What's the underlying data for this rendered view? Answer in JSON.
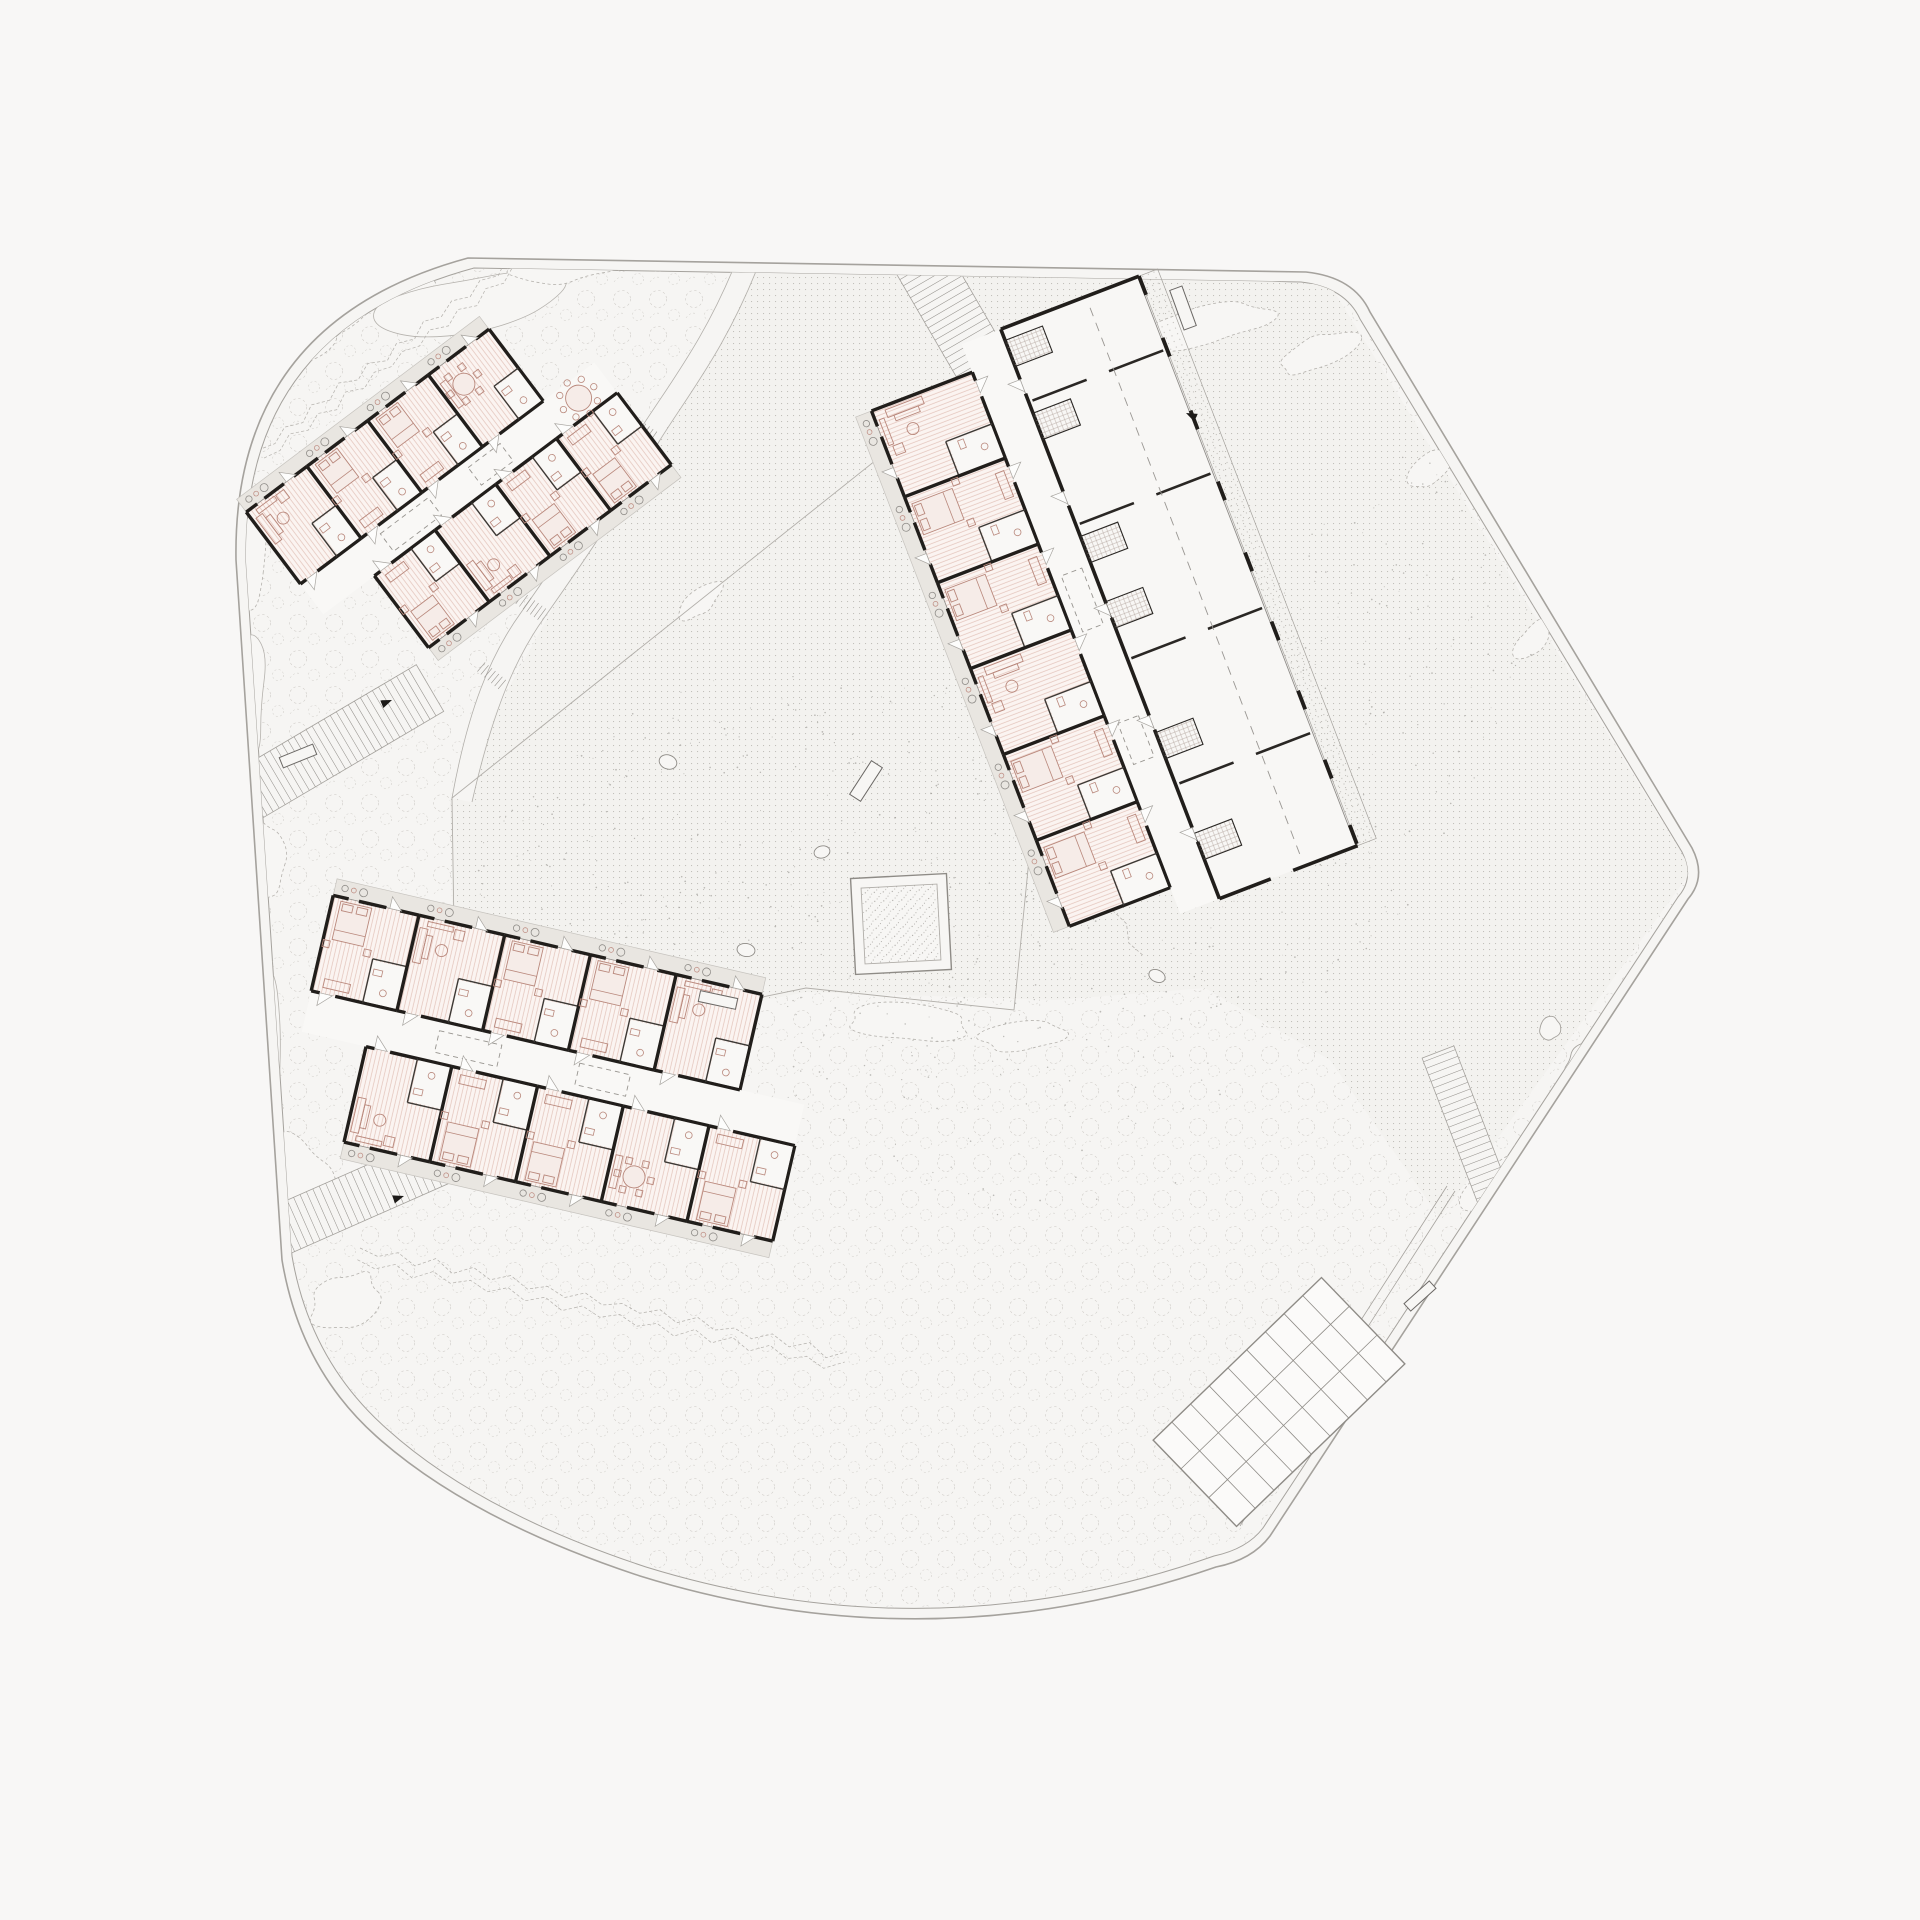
{
  "document": {
    "type": "architectural-site-plan",
    "level": "ground-floor",
    "text_labels": "none-visible"
  },
  "canvas": {
    "width": 1920,
    "height": 1920,
    "viewbox": "0 0 1920 1920",
    "background": "#f8f7f6"
  },
  "palette": {
    "paper": "#f8f7f6",
    "site_fill": "#f6f5f3",
    "blob_fill": "#f7f6f4",
    "boundary_line": "#a5a29d",
    "texture_line": "#cbc8c3",
    "dot": "#b7b4af",
    "wall": "#211e1b",
    "inner_wall": "#3c3935",
    "thin_line": "#8f8c88",
    "floor_base": "#fbf4f1",
    "floor_hatch": "#e3c5bc",
    "porch_fill": "#e9e6e1",
    "furniture": "#b9887c",
    "furniture_fill": "#f6ece8",
    "hatch_path_line": "#96938e",
    "ground_dots_fill": "#f3f2ef",
    "pavilion_line": "#8e8b86",
    "speck": "#8d8a85",
    "arrow": "#1c1a18"
  },
  "site": {
    "outer": "M 468 258 L 1306 272 Q 1354 277 1370 312 L 1692 848 Q 1707 877 1688 899 L 1270 1536 Q 1252 1560 1216 1567 Q 930 1666 640 1576 Q 470 1520 376 1436 Q 300 1368 282 1260 L 236 560 Q 232 322 468 258 Z",
    "inner": "M 474 268 L 1301 282 Q 1345 287 1360 319 L 1682 852 Q 1695 878 1678 897 L 1263 1528 Q 1247 1549 1214 1556 Q 932 1655 646 1567 Q 479 1512 387 1429 Q 310 1361 292 1256 L 246 562 Q 242 331 474 268 Z",
    "ground_dots_region": "M 750 250 L 1330 285 L 1692 870 L 1440 1218 L 1330 1060 L 1205 988 L 1056 1000 L 806 992 L 455 1062 L 450 795 Z",
    "courtyard_border": "M 452 798 L 905 437 L 1062 528 L 1014 1010 L 806 988 L 456 1060 Z"
  },
  "stream": {
    "mid": "M 750 254 C 716 343 677 390 647 438 C 609 502 579 548 531 616 C 501 658 479 712 461 800",
    "left": "M 740 252 C 706 340 666 388 636 436 C 598 500 568 546 520 614 C 490 656 468 710 452 798",
    "right": "M 762 256 C 728 346 690 392 660 440 C 622 504 592 550 544 618 C 514 660 492 714 472 802"
  },
  "hatch_steps": [
    {
      "x": 641,
      "y": 429,
      "w": 34,
      "h": 14,
      "rot": 35
    },
    {
      "x": 587,
      "y": 519,
      "w": 32,
      "h": 14,
      "rot": 38
    },
    {
      "x": 532,
      "y": 607,
      "w": 30,
      "h": 14,
      "rot": 36
    },
    {
      "x": 492,
      "y": 676,
      "w": 28,
      "h": 12,
      "rot": 40
    }
  ],
  "paths": [
    {
      "name": "entry-path-north",
      "x1": 915,
      "y1": 250,
      "x2": 1072,
      "y2": 520,
      "w": 56
    },
    {
      "name": "entry-path-west",
      "x1": 250,
      "y1": 794,
      "x2": 430,
      "y2": 688,
      "w": 54
    },
    {
      "name": "entry-path-southwest",
      "x1": 268,
      "y1": 1236,
      "x2": 440,
      "y2": 1160,
      "w": 50
    },
    {
      "name": "path-southeast",
      "x1": 1438,
      "y1": 1052,
      "x2": 1514,
      "y2": 1250,
      "w": 34
    }
  ],
  "buildings": [
    {
      "key": "A",
      "name": "building-northwest",
      "cx": 462,
      "cy": 486,
      "rot": -37,
      "corridor": 19,
      "skylights": [
        {
          "x": -64,
          "w": 60
        },
        {
          "x": 36,
          "w": 40
        }
      ],
      "corridor_table": {
        "x": 146,
        "y": 0,
        "r": 13
      },
      "wings": [
        {
          "s": -1,
          "x0": -188,
          "units": 4,
          "uw": 76,
          "depth": 90,
          "porch": 16,
          "types": [
            "living",
            "bed",
            "bed",
            "dine"
          ]
        },
        {
          "s": 1,
          "x0": -124,
          "units": 4,
          "uw": 76,
          "depth": 90,
          "porch": 16,
          "types": [
            "bed",
            "living",
            "bed",
            "bed"
          ]
        }
      ]
    },
    {
      "key": "B",
      "name": "building-east",
      "cx": 1093,
      "cy": 628,
      "rot": 69,
      "corridor": 21,
      "skylights": [
        {
          "x": -30,
          "w": 60
        },
        {
          "x": 120,
          "w": 44
        }
      ],
      "wings": [
        {
          "s": 1,
          "x0": -282,
          "units": 6,
          "uw": 92,
          "depth": 108,
          "porch": 17,
          "types": [
            "living",
            "bed",
            "bed",
            "living",
            "bed",
            "bed"
          ]
        }
      ],
      "hall": {
        "x0": -312,
        "x1": 298,
        "depth": 148,
        "veranda": 20,
        "piers": [
          -312,
          -246,
          -168,
          -92,
          -16,
          58,
          132,
          206,
          276
        ],
        "doors": [
          -258,
          -138,
          -18,
          102,
          222
        ],
        "cross": [
          -234,
          -102,
          42,
          176
        ],
        "services": [
          -300,
          -222,
          -90,
          -20,
          120,
          228
        ],
        "dash_y": -112
      }
    },
    {
      "key": "C",
      "name": "building-south",
      "cx": 552,
      "cy": 1068,
      "rot": 13,
      "corridor": 21,
      "skylights": [
        {
          "x": -86,
          "w": 64
        },
        {
          "x": 52,
          "w": 52
        }
      ],
      "wings": [
        {
          "s": -1,
          "x0": -252,
          "units": 5,
          "uw": 88,
          "depth": 98,
          "porch": 17,
          "types": [
            "bed",
            "living",
            "bed",
            "bed",
            "living"
          ]
        },
        {
          "s": 1,
          "x0": -186,
          "units": 5,
          "uw": 88,
          "depth": 98,
          "porch": 17,
          "types": [
            "living",
            "bed",
            "bed",
            "dine",
            "bed"
          ]
        }
      ]
    }
  ],
  "pavilion": {
    "cx": 901,
    "cy": 924,
    "size": 96,
    "inset": 10,
    "rot": -3
  },
  "pergola": {
    "cx": 1279,
    "cy": 1402,
    "w": 120,
    "h": 234,
    "rot": 46,
    "cols": [
      -20,
      20
    ],
    "rowstep": 26
  },
  "road_lines": [
    {
      "x1": 1455,
      "y1": 1191,
      "x2": 1240,
      "y2": 1526
    },
    {
      "x1": 1447,
      "y1": 1186,
      "x2": 1232,
      "y2": 1521
    }
  ],
  "waves": [
    {
      "x1": 258,
      "y1": 450,
      "x2": 524,
      "y2": 252,
      "amp": 4,
      "wl": 17,
      "off": 10
    },
    {
      "x1": 360,
      "y1": 1248,
      "x2": 846,
      "y2": 1356,
      "amp": 4.5,
      "wl": 19,
      "off": 12
    },
    {
      "x1": 882,
      "y1": 430,
      "x2": 1140,
      "y2": 958,
      "amp": 4,
      "wl": 18,
      "off": 0
    }
  ],
  "blobs": [
    [
      332,
      310,
      64,
      22,
      -28,
      "d"
    ],
    [
      400,
      285,
      38,
      15,
      -14,
      "d"
    ],
    [
      470,
      302,
      92,
      26,
      -10,
      "s"
    ],
    [
      560,
      266,
      58,
      17,
      -6,
      "d"
    ],
    [
      305,
      352,
      30,
      12,
      -30,
      "d"
    ],
    [
      248,
      560,
      20,
      46,
      4,
      "d"
    ],
    [
      240,
      706,
      24,
      82,
      2,
      "s"
    ],
    [
      262,
      856,
      22,
      42,
      -6,
      "d"
    ],
    [
      255,
      1020,
      26,
      72,
      -8,
      "s"
    ],
    [
      300,
      1180,
      30,
      48,
      -18,
      "d"
    ],
    [
      344,
      1302,
      38,
      26,
      -30,
      "d"
    ],
    [
      1205,
      325,
      64,
      20,
      -10,
      "d"
    ],
    [
      1322,
      352,
      42,
      16,
      -25,
      "d"
    ],
    [
      1430,
      470,
      26,
      14,
      -40,
      "d"
    ],
    [
      1532,
      640,
      22,
      12,
      -50,
      "d"
    ],
    [
      905,
      1022,
      62,
      18,
      3,
      "d"
    ],
    [
      1020,
      1036,
      42,
      14,
      -4,
      "d"
    ],
    [
      1500,
      1180,
      40,
      18,
      -35,
      "d"
    ],
    [
      636,
      960,
      16,
      11,
      20,
      "s"
    ],
    [
      700,
      600,
      26,
      12,
      -40,
      "d"
    ]
  ],
  "stones": [
    [
      668,
      762,
      18,
      14,
      20
    ],
    [
      822,
      852,
      16,
      12,
      -15
    ],
    [
      746,
      950,
      18,
      13,
      10
    ],
    [
      1126,
      858,
      15,
      11,
      0
    ],
    [
      1157,
      976,
      17,
      12,
      25
    ],
    [
      637,
      1006,
      13,
      10,
      -30
    ]
  ],
  "trees": [
    [
      1592,
      1070,
      26
    ],
    [
      1604,
      1152,
      28
    ],
    [
      1550,
      1028,
      11
    ]
  ],
  "benches": [
    [
      298,
      756,
      36,
      11,
      -22
    ],
    [
      866,
      781,
      40,
      13,
      -57
    ],
    [
      718,
      1000,
      38,
      11,
      12
    ],
    [
      1420,
      1296,
      34,
      10,
      -42
    ],
    [
      1183,
      308,
      13,
      42,
      -20
    ]
  ],
  "arrows": [
    {
      "x": 1186,
      "y": 413,
      "a": 205
    },
    {
      "x": 392,
      "y": 700,
      "a": -22
    },
    {
      "x": 404,
      "y": 1196,
      "a": -18
    }
  ],
  "speckle_zones": [
    {
      "cx": 790,
      "cy": 900,
      "rx": 330,
      "ry": 230,
      "rot": -8,
      "n": 520
    },
    {
      "cx": 1340,
      "cy": 740,
      "rx": 150,
      "ry": 330,
      "rot": 28,
      "n": 260
    },
    {
      "cx": 1050,
      "cy": 1100,
      "rx": 180,
      "ry": 120,
      "rot": 0,
      "n": 90
    }
  ]
}
